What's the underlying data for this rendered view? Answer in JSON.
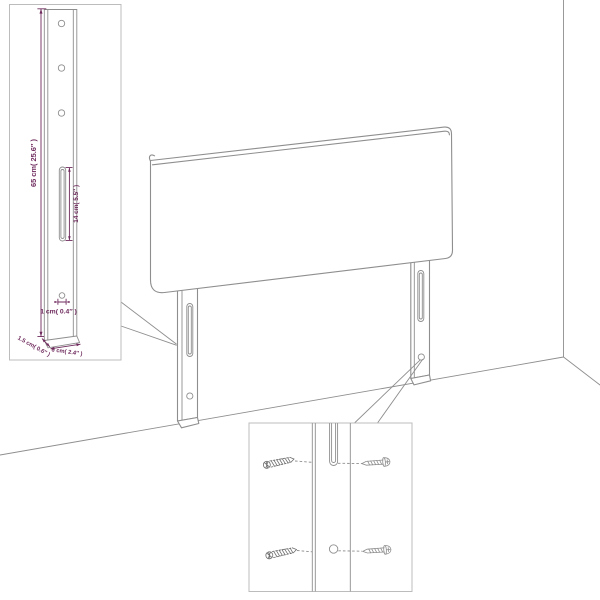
{
  "colors": {
    "background": "#ffffff",
    "line-gray": "#8e8e8e",
    "border-gray": "#bcbcbc",
    "hardware-gray": "#6e6e6e",
    "dim-purple": "#6e2a5c"
  },
  "main_drawing": {
    "object": "headboard-panel-with-two-slotted-legs",
    "environment": "room-corner-perspective"
  },
  "left_callout": {
    "shows": "leg-detail-front-view",
    "top_hole_count": 3,
    "labels": {
      "height": "65 cm( 25.6″ )",
      "slot": "14 cm( 5.5″ )",
      "hole": "1 cm( 0.4″ )",
      "thickness": "1.5 cm( 0.6″ )",
      "width": "6 cm( 2.4″ )"
    }
  },
  "right_callout": {
    "shows": "slot-and-hole-fastening-detail",
    "wall_plug_count": 2,
    "screw_count": 2
  }
}
